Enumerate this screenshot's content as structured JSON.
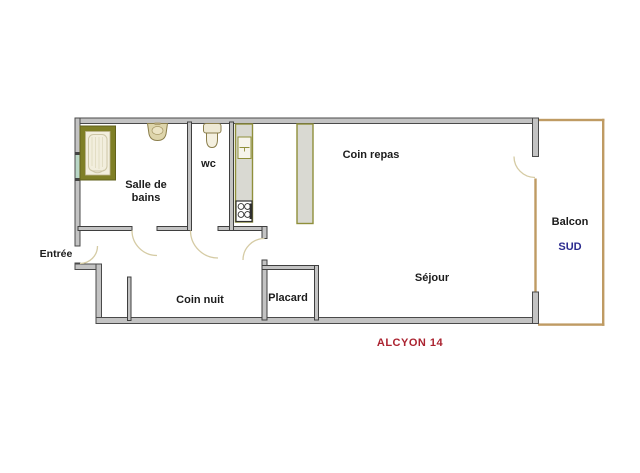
{
  "plan": {
    "caption": "ALCYON 14",
    "labels": {
      "salle_de_bains": "Salle de bains",
      "wc": "wc",
      "coin_repas": "Coin repas",
      "sejour": "Séjour",
      "balcon": "Balcon",
      "sud": "SUD",
      "entree": "Entrée",
      "coin_nuit": "Coin nuit",
      "placard": "Placard"
    },
    "colors": {
      "wall_gray": "#c3c3c3",
      "wall_edge": "#4a4a4a",
      "fixture_olive": "#7f7f26",
      "counter_fill": "#d9d9d2",
      "counter_border": "#8f8f3a",
      "balcony_tan": "#bf9b63",
      "door_arc_beige": "#d5cba4",
      "window_teal": "#b9d6c6",
      "caption_red": "#ab2330",
      "sud_navy": "#2b2b8f",
      "label_black": "#1c1c1c"
    }
  }
}
